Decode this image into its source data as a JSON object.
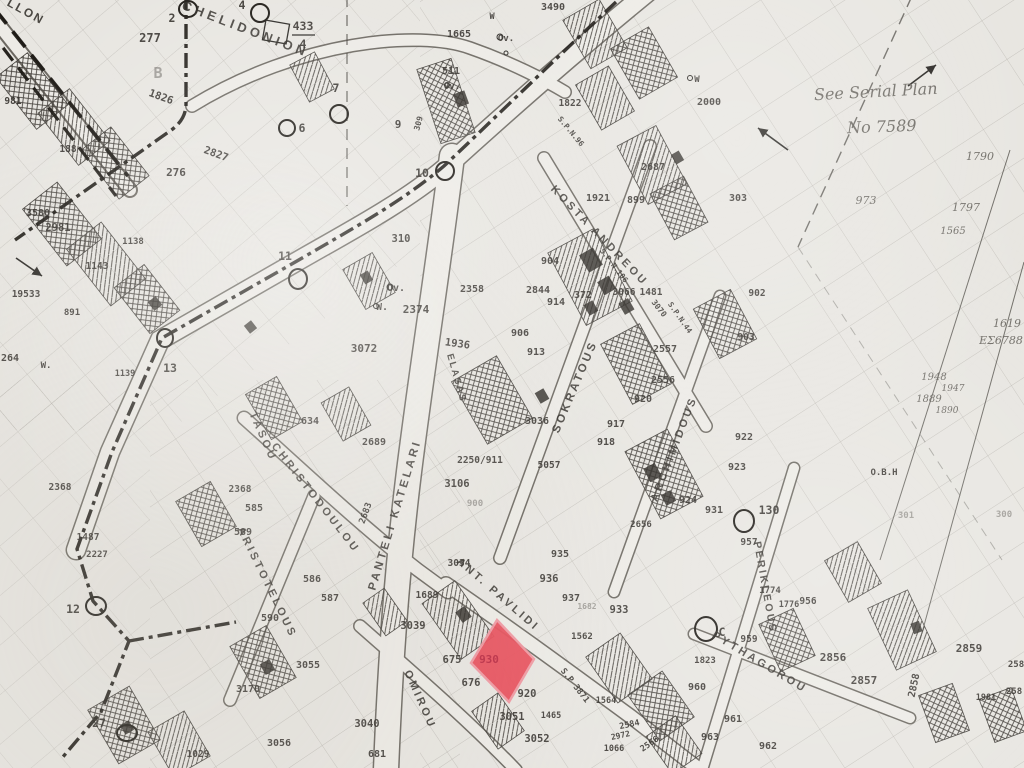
{
  "map": {
    "sheet_note": {
      "line1": "See Serial Plan",
      "line2": "No 7589"
    },
    "highlight": {
      "plot_number": "930",
      "color": "#e84a57"
    },
    "streets": [
      {
        "name": "LLON",
        "x": 24,
        "y": 15,
        "r": 29,
        "s": 12,
        "ls": 2
      },
      {
        "name": "CHELIDONION",
        "x": 244,
        "y": 33,
        "r": 21,
        "s": 13,
        "ls": 4
      },
      {
        "name": "TASOU",
        "x": 260,
        "y": 438,
        "r": 66,
        "s": 11,
        "ls": 3
      },
      {
        "name": "CHRISTODOULOU",
        "x": 313,
        "y": 500,
        "r": 52,
        "s": 11,
        "ls": 3
      },
      {
        "name": "ARISTOTELOUS",
        "x": 264,
        "y": 584,
        "r": 64,
        "s": 11,
        "ls": 3
      },
      {
        "name": "PANTELI KATELARI",
        "x": 398,
        "y": 516,
        "r": -73,
        "s": 11.5,
        "ls": 3
      },
      {
        "name": "SOKRATOUS",
        "x": 578,
        "y": 388,
        "r": -67,
        "s": 11.5,
        "ls": 3
      },
      {
        "name": "KOSTA ANDREOU",
        "x": 597,
        "y": 238,
        "r": 46,
        "s": 11,
        "ls": 3
      },
      {
        "name": "ARCHIMIDOUS",
        "x": 677,
        "y": 450,
        "r": -69,
        "s": 11,
        "ls": 3
      },
      {
        "name": "PERIKLEOUS",
        "x": 762,
        "y": 588,
        "r": 80,
        "s": 10.5,
        "ls": 2.5
      },
      {
        "name": "PYTHAGOROU",
        "x": 758,
        "y": 665,
        "r": 31,
        "s": 11,
        "ls": 3
      },
      {
        "name": "ANT. PAVLIDI",
        "x": 496,
        "y": 597,
        "r": 41,
        "s": 11,
        "ls": 3
      },
      {
        "name": "OMIROU",
        "x": 417,
        "y": 701,
        "r": 66,
        "s": 11,
        "ls": 3
      },
      {
        "name": "ELASAS",
        "x": 454,
        "y": 379,
        "r": 74,
        "s": 9.5,
        "ls": 2
      }
    ],
    "annotations": [
      {
        "t": "See Serial Plan",
        "x": 876,
        "y": 97,
        "r": -3,
        "s": 16
      },
      {
        "t": "No 7589",
        "x": 882,
        "y": 132,
        "r": -2,
        "s": 16
      },
      {
        "t": "ΕΣ6788",
        "x": 1001,
        "y": 344,
        "r": 0,
        "s": 11
      },
      {
        "t": "973",
        "x": 866,
        "y": 204,
        "r": 0,
        "s": 11
      },
      {
        "t": "1790",
        "x": 980,
        "y": 160,
        "r": 0,
        "s": 11
      },
      {
        "t": "1797",
        "x": 966,
        "y": 211,
        "r": 0,
        "s": 11
      },
      {
        "t": "1565",
        "x": 953,
        "y": 234,
        "r": 0,
        "s": 10
      },
      {
        "t": "1619",
        "x": 1007,
        "y": 327,
        "r": 0,
        "s": 11
      },
      {
        "t": "1948",
        "x": 934,
        "y": 380,
        "r": 0,
        "s": 10
      },
      {
        "t": "1947",
        "x": 953,
        "y": 391,
        "r": 0,
        "s": 9
      },
      {
        "t": "1889",
        "x": 929,
        "y": 402,
        "r": 0,
        "s": 10
      },
      {
        "t": "1890",
        "x": 947,
        "y": 413,
        "r": 0,
        "s": 9
      }
    ],
    "circles": [
      {
        "l": "2",
        "cx": 188,
        "cy": 9,
        "rx": 9,
        "ry": 8,
        "lx": 172,
        "ly": 22
      },
      {
        "l": "4",
        "cx": 260,
        "cy": 13,
        "rx": 9,
        "ry": 9,
        "lx": 242,
        "ly": 9
      },
      {
        "l": "6",
        "cx": 287,
        "cy": 128,
        "rx": 8,
        "ry": 8,
        "lx": 302,
        "ly": 132
      },
      {
        "l": "7",
        "cx": 339,
        "cy": 114,
        "rx": 9,
        "ry": 9,
        "lx": 336,
        "ly": 92
      },
      {
        "l": "10",
        "cx": 445,
        "cy": 171,
        "rx": 9,
        "ry": 9,
        "lx": 422,
        "ly": 177
      },
      {
        "l": "11",
        "cx": 298,
        "cy": 279,
        "rx": 9,
        "ry": 10,
        "lx": 285,
        "ly": 260
      },
      {
        "l": "13",
        "cx": 165,
        "cy": 338,
        "rx": 8,
        "ry": 9,
        "lx": 170,
        "ly": 372
      },
      {
        "l": "12",
        "cx": 96,
        "cy": 606,
        "rx": 10,
        "ry": 9,
        "lx": 73,
        "ly": 613
      },
      {
        "l": "27",
        "cx": 127,
        "cy": 733,
        "rx": 10,
        "ry": 8,
        "lx": 99,
        "ly": 727
      },
      {
        "l": "130",
        "cx": 744,
        "cy": 521,
        "rx": 10,
        "ry": 11,
        "lx": 769,
        "ly": 514
      },
      {
        "l": "C",
        "cx": 706,
        "cy": 629,
        "rx": 11,
        "ry": 12,
        "lx": 722,
        "ly": 636
      }
    ],
    "plot_numbers": [
      {
        "t": "9",
        "x": 398,
        "y": 128,
        "s": 11
      },
      {
        "t": "433",
        "x": 303,
        "y": 30,
        "s": 11.5
      },
      {
        "t": "4",
        "x": 303,
        "y": 48,
        "s": 11.5
      },
      {
        "t": "1826",
        "x": 160,
        "y": 100,
        "r": 20,
        "s": 10.5
      },
      {
        "t": "2827",
        "x": 215,
        "y": 157,
        "r": 20,
        "s": 10.5
      },
      {
        "t": "981",
        "x": 13,
        "y": 104,
        "s": 9.5
      },
      {
        "t": "188",
        "x": 68,
        "y": 152,
        "s": 9.5
      },
      {
        "t": "277",
        "x": 150,
        "y": 42,
        "s": 12
      },
      {
        "t": "B",
        "x": 158,
        "y": 78,
        "s": 15,
        "c": "faint"
      },
      {
        "t": "276",
        "x": 176,
        "y": 176,
        "s": 11
      },
      {
        "t": "3580",
        "x": 38,
        "y": 216,
        "s": 10
      },
      {
        "t": "2981",
        "x": 58,
        "y": 231,
        "s": 10.5
      },
      {
        "t": "1143",
        "x": 97,
        "y": 269,
        "s": 9.5
      },
      {
        "t": "1138",
        "x": 133,
        "y": 244,
        "s": 9
      },
      {
        "t": "19533",
        "x": 26,
        "y": 297,
        "s": 9.5
      },
      {
        "t": "891",
        "x": 72,
        "y": 315,
        "s": 9
      },
      {
        "t": "264",
        "x": 10,
        "y": 361,
        "s": 10
      },
      {
        "t": "W.",
        "x": 46,
        "y": 368,
        "s": 9
      },
      {
        "t": "1139",
        "x": 125,
        "y": 376,
        "s": 8.5
      },
      {
        "t": "1487",
        "x": 88,
        "y": 540,
        "s": 9.5
      },
      {
        "t": "2227",
        "x": 97,
        "y": 557,
        "s": 9
      },
      {
        "t": "2368",
        "x": 60,
        "y": 490,
        "s": 9.5
      },
      {
        "t": "2368",
        "x": 240,
        "y": 492,
        "s": 9.5
      },
      {
        "t": "585",
        "x": 254,
        "y": 511,
        "s": 10
      },
      {
        "t": "589",
        "x": 243,
        "y": 535,
        "s": 10
      },
      {
        "t": "586",
        "x": 312,
        "y": 582,
        "s": 10
      },
      {
        "t": "587",
        "x": 330,
        "y": 601,
        "s": 10
      },
      {
        "t": "590",
        "x": 270,
        "y": 621,
        "s": 10
      },
      {
        "t": "634",
        "x": 310,
        "y": 424,
        "s": 10
      },
      {
        "t": "2689",
        "x": 374,
        "y": 445,
        "s": 10
      },
      {
        "t": "2683",
        "x": 368,
        "y": 514,
        "r": -70,
        "s": 9
      },
      {
        "t": "1689",
        "x": 427,
        "y": 598,
        "s": 9.5
      },
      {
        "t": "3039",
        "x": 413,
        "y": 629,
        "s": 10.5
      },
      {
        "t": "3055",
        "x": 308,
        "y": 668,
        "s": 10
      },
      {
        "t": "3170",
        "x": 248,
        "y": 692,
        "s": 10
      },
      {
        "t": "3056",
        "x": 279,
        "y": 746,
        "s": 10
      },
      {
        "t": "1029",
        "x": 198,
        "y": 757,
        "s": 9.5
      },
      {
        "t": "3040",
        "x": 367,
        "y": 727,
        "s": 10.5
      },
      {
        "t": "681",
        "x": 377,
        "y": 757,
        "s": 10
      },
      {
        "t": "675",
        "x": 452,
        "y": 663,
        "s": 10.5
      },
      {
        "t": "676",
        "x": 471,
        "y": 686,
        "s": 10.5
      },
      {
        "t": "930",
        "x": 489,
        "y": 663,
        "s": 11,
        "c": "red"
      },
      {
        "t": "920",
        "x": 527,
        "y": 697,
        "s": 10.5
      },
      {
        "t": "3051",
        "x": 512,
        "y": 720,
        "s": 10.5
      },
      {
        "t": "3052",
        "x": 537,
        "y": 742,
        "s": 10.5
      },
      {
        "t": "1562",
        "x": 582,
        "y": 639,
        "s": 9
      },
      {
        "t": "S.P 3871",
        "x": 573,
        "y": 687,
        "r": 52,
        "s": 8.5
      },
      {
        "t": "1564",
        "x": 606,
        "y": 703,
        "s": 8.5
      },
      {
        "t": "1465",
        "x": 551,
        "y": 718,
        "s": 8.5
      },
      {
        "t": "2584",
        "x": 630,
        "y": 727,
        "r": -12,
        "s": 8.5
      },
      {
        "t": "2566",
        "x": 651,
        "y": 746,
        "r": -35,
        "s": 8.5
      },
      {
        "t": "2972",
        "x": 621,
        "y": 738,
        "r": -12,
        "s": 8
      },
      {
        "t": "1066",
        "x": 614,
        "y": 751,
        "s": 8.5
      },
      {
        "t": "960",
        "x": 697,
        "y": 690,
        "s": 10
      },
      {
        "t": "961",
        "x": 733,
        "y": 722,
        "s": 10
      },
      {
        "t": "963",
        "x": 710,
        "y": 740,
        "s": 10
      },
      {
        "t": "962",
        "x": 768,
        "y": 749,
        "s": 10
      },
      {
        "t": "1823",
        "x": 705,
        "y": 663,
        "s": 9
      },
      {
        "t": "959",
        "x": 749,
        "y": 642,
        "s": 9.5
      },
      {
        "t": "956",
        "x": 808,
        "y": 604,
        "s": 9.5
      },
      {
        "t": "2856",
        "x": 833,
        "y": 661,
        "s": 11
      },
      {
        "t": "2857",
        "x": 864,
        "y": 684,
        "s": 11
      },
      {
        "t": "2859",
        "x": 969,
        "y": 652,
        "s": 11
      },
      {
        "t": "2858",
        "x": 917,
        "y": 686,
        "r": -78,
        "s": 10
      },
      {
        "t": "1981",
        "x": 986,
        "y": 700,
        "s": 8.5
      },
      {
        "t": "258",
        "x": 1016,
        "y": 667,
        "s": 9
      },
      {
        "t": "258",
        "x": 1014,
        "y": 694,
        "s": 9
      },
      {
        "t": "957",
        "x": 749,
        "y": 545,
        "s": 9.5
      },
      {
        "t": "922",
        "x": 744,
        "y": 440,
        "s": 10
      },
      {
        "t": "923",
        "x": 737,
        "y": 470,
        "s": 10
      },
      {
        "t": "924",
        "x": 688,
        "y": 503,
        "s": 10
      },
      {
        "t": "931",
        "x": 714,
        "y": 513,
        "s": 10
      },
      {
        "t": "2656",
        "x": 641,
        "y": 527,
        "s": 9
      },
      {
        "t": "917",
        "x": 616,
        "y": 427,
        "s": 10
      },
      {
        "t": "918",
        "x": 606,
        "y": 445,
        "s": 10
      },
      {
        "t": "920",
        "x": 643,
        "y": 402,
        "s": 10
      },
      {
        "t": "2556",
        "x": 663,
        "y": 383,
        "s": 10
      },
      {
        "t": "2557",
        "x": 665,
        "y": 352,
        "s": 10
      },
      {
        "t": "935",
        "x": 560,
        "y": 557,
        "s": 10
      },
      {
        "t": "936",
        "x": 549,
        "y": 582,
        "s": 10.5
      },
      {
        "t": "937",
        "x": 571,
        "y": 601,
        "s": 10
      },
      {
        "t": "933",
        "x": 619,
        "y": 613,
        "s": 10.5
      },
      {
        "t": "3034",
        "x": 459,
        "y": 566,
        "s": 9.5
      },
      {
        "t": "2250/911",
        "x": 480,
        "y": 463,
        "s": 9.5
      },
      {
        "t": "3106",
        "x": 457,
        "y": 487,
        "s": 10.5
      },
      {
        "t": "900",
        "x": 475,
        "y": 506,
        "s": 9,
        "c": "faint"
      },
      {
        "t": "5057",
        "x": 549,
        "y": 468,
        "s": 9.5
      },
      {
        "t": "3036",
        "x": 537,
        "y": 424,
        "s": 10
      },
      {
        "t": "1936",
        "x": 457,
        "y": 347,
        "r": 8,
        "s": 10.5
      },
      {
        "t": "2358",
        "x": 472,
        "y": 292,
        "s": 10
      },
      {
        "t": "2374",
        "x": 416,
        "y": 313,
        "s": 11
      },
      {
        "t": "310",
        "x": 401,
        "y": 242,
        "s": 10.5
      },
      {
        "t": "3072",
        "x": 364,
        "y": 352,
        "s": 11
      },
      {
        "t": "Ov.",
        "x": 396,
        "y": 291,
        "s": 10
      },
      {
        "t": "W.",
        "x": 382,
        "y": 310,
        "s": 10
      },
      {
        "t": "2844",
        "x": 538,
        "y": 293,
        "s": 10
      },
      {
        "t": "914",
        "x": 556,
        "y": 305,
        "s": 10
      },
      {
        "t": "372",
        "x": 583,
        "y": 298,
        "s": 10
      },
      {
        "t": "904",
        "x": 550,
        "y": 264,
        "s": 10
      },
      {
        "t": "906",
        "x": 520,
        "y": 336,
        "s": 10
      },
      {
        "t": "913",
        "x": 536,
        "y": 355,
        "s": 10
      },
      {
        "t": "1921",
        "x": 598,
        "y": 201,
        "s": 10
      },
      {
        "t": "899",
        "x": 636,
        "y": 203,
        "s": 10
      },
      {
        "t": "2687",
        "x": 653,
        "y": 170,
        "s": 10
      },
      {
        "t": "2000",
        "x": 709,
        "y": 105,
        "s": 10
      },
      {
        "t": "W",
        "x": 697,
        "y": 82,
        "s": 9
      },
      {
        "t": "303",
        "x": 738,
        "y": 201,
        "s": 10
      },
      {
        "t": "3490",
        "x": 553,
        "y": 10,
        "s": 10
      },
      {
        "t": "1665",
        "x": 459,
        "y": 37,
        "s": 10
      },
      {
        "t": "511",
        "x": 451,
        "y": 74,
        "s": 10
      },
      {
        "t": "Ov.",
        "x": 506,
        "y": 41,
        "s": 9
      },
      {
        "t": "W",
        "x": 492,
        "y": 19,
        "s": 8.5
      },
      {
        "t": "Ov.",
        "x": 452,
        "y": 89,
        "s": 9
      },
      {
        "t": "1822",
        "x": 570,
        "y": 106,
        "s": 9.5
      },
      {
        "t": "S.P.N.96",
        "x": 569,
        "y": 133,
        "r": 50,
        "s": 7.5
      },
      {
        "t": "309",
        "x": 421,
        "y": 124,
        "r": -75,
        "s": 8
      },
      {
        "t": "S.P.N.106",
        "x": 612,
        "y": 267,
        "r": 52,
        "s": 7.5
      },
      {
        "t": "3066",
        "x": 624,
        "y": 295,
        "s": 9.5
      },
      {
        "t": "1481",
        "x": 651,
        "y": 295,
        "s": 9.5
      },
      {
        "t": "3070",
        "x": 657,
        "y": 310,
        "r": 52,
        "s": 8
      },
      {
        "t": "S.P.N.44",
        "x": 678,
        "y": 319,
        "r": 55,
        "s": 7.5
      },
      {
        "t": "902",
        "x": 757,
        "y": 296,
        "s": 9.5
      },
      {
        "t": "903",
        "x": 746,
        "y": 340,
        "s": 9.5
      },
      {
        "t": "O.B.H",
        "x": 884,
        "y": 475,
        "s": 9
      },
      {
        "t": "301",
        "x": 906,
        "y": 518,
        "s": 9,
        "c": "faint"
      },
      {
        "t": "300",
        "x": 1004,
        "y": 517,
        "s": 9,
        "c": "faint"
      },
      {
        "t": "1774",
        "x": 770,
        "y": 593,
        "s": 9
      },
      {
        "t": "1776",
        "x": 789,
        "y": 607,
        "s": 8.5
      },
      {
        "t": "1682",
        "x": 587,
        "y": 609,
        "s": 8,
        "c": "faint"
      }
    ]
  }
}
